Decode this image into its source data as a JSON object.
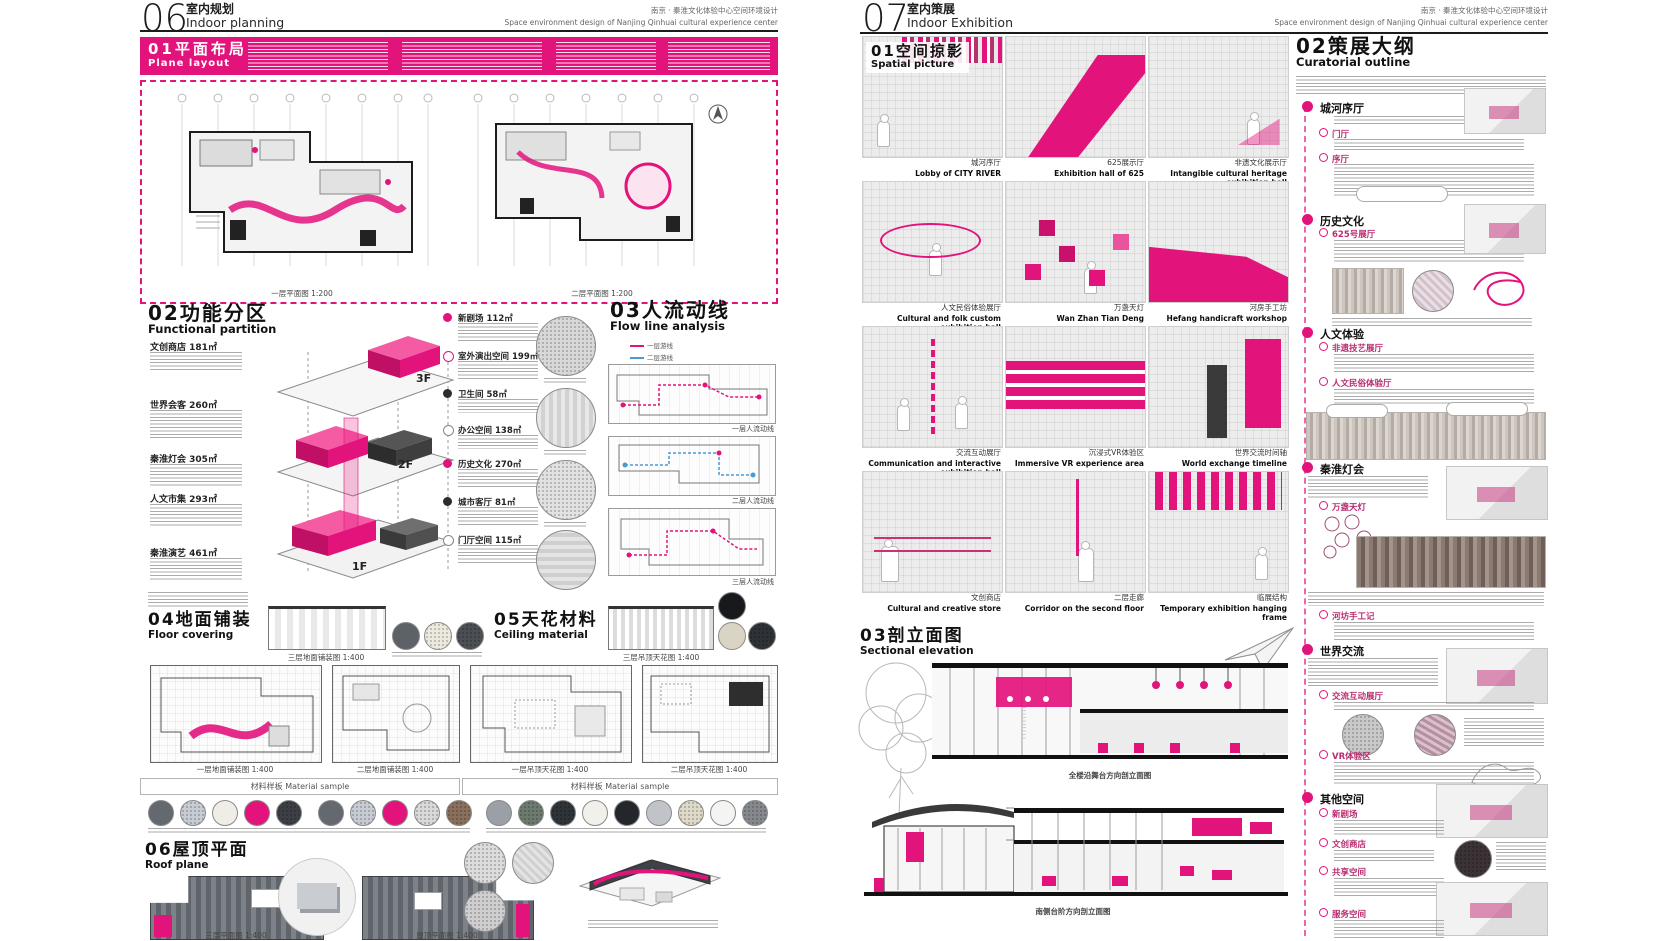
{
  "project": {
    "title_cn": "南京 · 秦淮文化体验中心空间环境设计",
    "title_en": "Space environment design of Nanjing Qinhuai cultural experience center"
  },
  "accent": "#e3137c",
  "left": {
    "page_no": "06",
    "title_cn": "室内规划",
    "title_en": "Indoor planning",
    "s01": {
      "no": "01",
      "cn": "平面布局",
      "en": "Plane layout"
    },
    "plans01": [
      "一层平面图 1:200",
      "二层平面图 1:200"
    ],
    "s02": {
      "no": "02",
      "cn": "功能分区",
      "en": "Functional partition"
    },
    "floors": [
      "3F",
      "2F",
      "1F"
    ],
    "zones_left": [
      {
        "name": "文创商店",
        "area": "181㎡"
      },
      {
        "name": "世界会客",
        "area": "260㎡"
      },
      {
        "name": "秦淮灯会",
        "area": "305㎡"
      },
      {
        "name": "人文市集",
        "area": "293㎡"
      },
      {
        "name": "秦淮演艺",
        "area": "461㎡"
      }
    ],
    "zones_right": [
      {
        "name": "新剧场",
        "area": "112㎡"
      },
      {
        "name": "室外演出空间",
        "area": "199㎡"
      },
      {
        "name": "卫生间",
        "area": "58㎡"
      },
      {
        "name": "办公空间",
        "area": "138㎡"
      },
      {
        "name": "历史文化",
        "area": "270㎡"
      },
      {
        "name": "城市客厅",
        "area": "81㎡"
      },
      {
        "name": "门厅空间",
        "area": "115㎡"
      }
    ],
    "s03": {
      "no": "03",
      "cn": "人流动线",
      "en": "Flow line analysis"
    },
    "flow_legend": [
      "一层游线",
      "二层游线"
    ],
    "flow_caps": [
      "一层人流动线",
      "二层人流动线",
      "三层人流动线"
    ],
    "s04": {
      "no": "04",
      "cn": "地面铺装",
      "en": "Floor covering"
    },
    "s04_detail_cap": "三层地面铺装图 1:400",
    "s04_plan_caps": [
      "一层地面铺装图 1:400",
      "二层地面铺装图 1:400"
    ],
    "s05": {
      "no": "05",
      "cn": "天花材料",
      "en": "Ceiling material"
    },
    "s05_detail_cap": "三层吊顶天花图 1:400",
    "s05_plan_caps": [
      "一层吊顶天花图 1:400",
      "二层吊顶天花图 1:400"
    ],
    "material_bar": "材料样板  Material sample",
    "s06": {
      "no": "06",
      "cn": "屋顶平面",
      "en": "Roof plane"
    },
    "s06_plan_caps": [
      "三层平面图 1:400",
      "屋顶平面图 1:400"
    ],
    "sample_colors_a": [
      "#63696f",
      "#c7cbd3",
      "#efede5",
      "#e3137c",
      "#3c4045",
      "#63696f",
      "#c7cbd3",
      "#e3137c",
      "#d9d9d9",
      "#8a6f5d"
    ],
    "sample_colors_b": [
      "#9aa0a5",
      "#6d7a6e",
      "#2f3438",
      "#f2f0ea",
      "#23272b",
      "#c0c4c8",
      "#ded9c8",
      "#f4f4f2",
      "#85898d"
    ],
    "s04_circle_colors": [
      "#5c6268",
      "#ece9df",
      "#4b5055"
    ],
    "s05_circle_colors": [
      "#d9d4c4",
      "#2e3236",
      "#17191c"
    ]
  },
  "right": {
    "page_no": "07",
    "title_cn": "室内策展",
    "title_en": "Indoor Exhibition",
    "s01": {
      "no": "01",
      "cn": "空间掠影",
      "en": "Spatial picture"
    },
    "gallery": [
      {
        "cn": "城河序厅",
        "en": "Lobby of CITY RIVER"
      },
      {
        "cn": "625展示厅",
        "en": "Exhibition hall of 625"
      },
      {
        "cn": "非遗文化展示厅",
        "en": "Intangible cultural heritage exhibition hall"
      },
      {
        "cn": "人文民俗体验展厅",
        "en": "Cultural and folk custom exhibition hall"
      },
      {
        "cn": "万盏天灯",
        "en": "Wan Zhan Tian Deng"
      },
      {
        "cn": "河房手工坊",
        "en": "Hefang handicraft workshop"
      },
      {
        "cn": "交流互动展厅",
        "en": "Communication and interactive exhibition hall"
      },
      {
        "cn": "沉浸式VR体验区",
        "en": "Immersive VR experience area"
      },
      {
        "cn": "世界交流时间轴",
        "en": "World exchange timeline"
      },
      {
        "cn": "文创商店",
        "en": "Cultural and creative store"
      },
      {
        "cn": "二层走廊",
        "en": "Corridor on the second floor"
      },
      {
        "cn": "临展结构",
        "en": "Temporary exhibition hanging frame"
      }
    ],
    "s02": {
      "no": "02",
      "cn": "策展大纲",
      "en": "Curatorial outline"
    },
    "timeline": [
      {
        "label": "城河序厅",
        "subs": [
          "门厅",
          "序厅"
        ]
      },
      {
        "label": "历史文化",
        "subs": [
          "625号展厅"
        ]
      },
      {
        "label": "人文体验",
        "subs": [
          "非遗技艺展厅",
          "人文民俗体验厅"
        ]
      },
      {
        "label": "秦淮灯会",
        "subs": [
          "万盏天灯",
          "河坊手工记"
        ]
      },
      {
        "label": "世界交流",
        "subs": [
          "交流互动展厅",
          "VR体验区"
        ]
      },
      {
        "label": "其他空间",
        "subs": [
          "新剧场",
          "文创商店",
          "共享空间",
          "服务空间"
        ]
      }
    ],
    "s03": {
      "no": "03",
      "cn": "剖立面图",
      "en": "Sectional elevation"
    },
    "section_caps": [
      "全楼沿舞台方向剖立面图",
      "南侧台阶方向剖立面图"
    ]
  }
}
